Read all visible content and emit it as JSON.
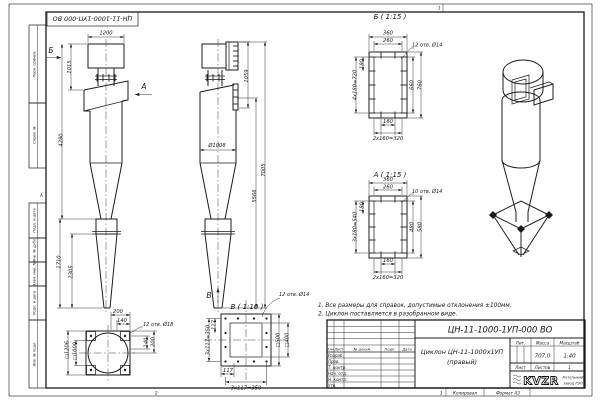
{
  "sheet": {
    "zone_top": "1",
    "zone_bottom_left": "2",
    "zone_bottom_num": "1",
    "zone_left": "А",
    "copied_label": "Копировал",
    "format_label": "Формат А3",
    "margin_labels": [
      "Перв. примен.",
      "Справ. №",
      "Подп. и дата",
      "Инв. № дубл.",
      "Взам. инв. №",
      "Подп. и дата",
      "Инв. № подл."
    ]
  },
  "front_view": {
    "dim_width_top": "1200",
    "dim_neck": "1015",
    "dim_body": "4280",
    "dim_bottom": "1710",
    "dim_cone": "1305",
    "arrow_b": "Б",
    "arrow_a": "А"
  },
  "side_view": {
    "dim_outlet": "1059",
    "dim_shell": "5566",
    "dim_total": "7005",
    "dia_label": "Ø1008",
    "arrow_v": "В"
  },
  "section_b": {
    "title": "Б ( 1:15 )",
    "dim_out_w": "360",
    "dim_in_w": "260",
    "holes_note": "12 отв. Ø14",
    "dim_left": "4x180=720",
    "dim_left_small": "180",
    "dim_right_in": "660",
    "dim_right_out": "760",
    "dim_bot_small": "160",
    "dim_bot": "2x160=320"
  },
  "section_a": {
    "title": "А ( 1:15 )",
    "dim_out_w": "360",
    "dim_in_w": "260",
    "holes_note": "10 отв. Ø14",
    "dim_left": "3x180=540",
    "dim_left_small": "180",
    "dim_right_in": "480",
    "dim_right_out": "580",
    "dim_bot_small": "160",
    "dim_bot": "2x160=320"
  },
  "view_v": {
    "title": "В ( 1:10 )",
    "holes_note": "12 отв. Ø14",
    "dim_left": "3x117=350",
    "dim_left_small": "117",
    "dim_bot_small": "117",
    "dim_bot": "3x117=350",
    "dim_sq_outer": "□500",
    "dim_sq_inner": "□400"
  },
  "support_view": {
    "dim_top": "200",
    "dim_top2": "140",
    "holes_note": "12 отв. Ø18",
    "dim_right": "140",
    "dim_right2": "200",
    "dim_sq_out": "□1206",
    "dim_sq_in": "□1000"
  },
  "notes": {
    "line1": "1. Все размеры для справок, допустимые отклонения ±100мм.",
    "line2": "2. Циклон поставляется в разобранном виде."
  },
  "titleblock": {
    "doc_number": "ЦН-11-1000-1УП-000 ВО",
    "title_line1": "Циклон ЦН-11-1000х1УП",
    "title_line2": "(правый)",
    "col_izm": "Изм.",
    "col_list": "Лист",
    "col_doc": "№ докум.",
    "col_podp": "Подп.",
    "col_data": "Дата",
    "rows": [
      "Разраб.",
      "Пров.",
      "Т. контр.",
      "Нач. отд.",
      "Н. контр.",
      "Утв."
    ],
    "lit_label": "Лит.",
    "mass_label": "Масса",
    "scale_label": "Масштаб",
    "mass_value": "707,0",
    "scale_value": "1:40",
    "sheet_label": "Лист",
    "sheets_label": "Листов",
    "sheets_value": "1",
    "logo_text": "KVZR",
    "org_line1": "Котельный",
    "org_line2": "завод РЭП"
  }
}
